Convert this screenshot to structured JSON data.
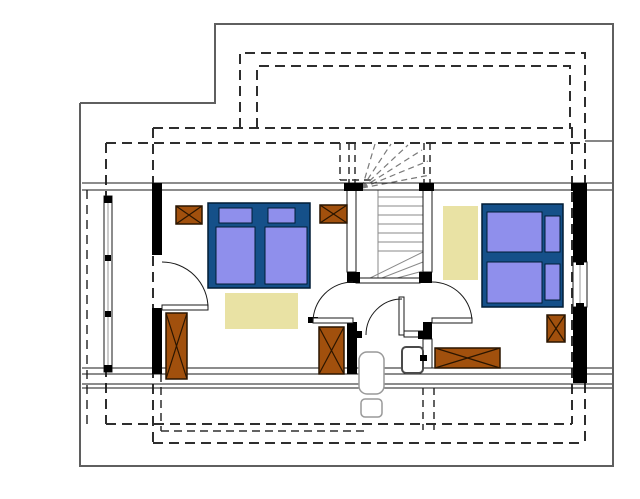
{
  "canvas": {
    "width": 640,
    "height": 499,
    "background": "#ffffff"
  },
  "colors": {
    "ink": "#1a1a1a",
    "wall": "#000000",
    "outline": "#5f5f5f",
    "dash": "#2e2e2e",
    "stairline": "#8a8a8a",
    "winderdash": "#7a7a7a",
    "brown": "#A1500D",
    "brownedge": "#2a1500",
    "bedframe": "#155089",
    "bededge": "#001c35",
    "mattress": "#8F8FEC",
    "rug": "#E9E2A4",
    "white": "#ffffff",
    "gray2": "#999999",
    "apedge": "#4a4a4a",
    "none": "none"
  },
  "shapes": [
    {
      "n": "ground-floor-outline",
      "t": "pl",
      "pts": "80,103 215,103 215,24 613,24 613,466 80,466 80,103",
      "s": "outline",
      "sw": 2
    },
    {
      "n": "ground-floor-edge-line",
      "t": "l",
      "x1": 585,
      "y1": 141,
      "x2": 613,
      "y2": 141,
      "s": "outline",
      "sw": 1.5
    },
    {
      "n": "dormer-roof-outer-dashed",
      "t": "p",
      "d": "M240,128 L240,53 L585,53 L585,141",
      "s": "dash",
      "sw": 2,
      "da": "10,6"
    },
    {
      "n": "dormer-roof-inner-dashed",
      "t": "p",
      "d": "M257,128 L257,66 L570,66 L570,128",
      "s": "dash",
      "sw": 2,
      "da": "10,6"
    },
    {
      "n": "roof-edge-top-inner",
      "t": "l",
      "x1": 153,
      "y1": 128,
      "x2": 573,
      "y2": 128,
      "s": "dash",
      "sw": 2,
      "da": "10,6"
    },
    {
      "n": "roof-edge-top-outer",
      "t": "l",
      "x1": 106,
      "y1": 143,
      "x2": 585,
      "y2": 143,
      "s": "dash",
      "sw": 2,
      "da": "10,6"
    },
    {
      "n": "roof-edge-left-outer",
      "t": "l",
      "x1": 106,
      "y1": 143,
      "x2": 106,
      "y2": 424,
      "s": "dash",
      "sw": 2,
      "da": "10,6"
    },
    {
      "n": "roof-edge-left-far",
      "t": "l",
      "x1": 87,
      "y1": 190,
      "x2": 87,
      "y2": 424,
      "s": "dash",
      "sw": 1.5,
      "da": "9,6"
    },
    {
      "n": "roof-edge-left-inner",
      "t": "l",
      "x1": 153,
      "y1": 128,
      "x2": 153,
      "y2": 443,
      "s": "dash",
      "sw": 2,
      "da": "10,6"
    },
    {
      "n": "roof-edge-left-short",
      "t": "l",
      "x1": 161,
      "y1": 374,
      "x2": 161,
      "y2": 431,
      "s": "dash",
      "sw": 1.5,
      "da": "8,5"
    },
    {
      "n": "roof-edge-right-inner",
      "t": "l",
      "x1": 572,
      "y1": 128,
      "x2": 572,
      "y2": 424,
      "s": "dash",
      "sw": 2,
      "da": "10,6"
    },
    {
      "n": "roof-edge-right-outer",
      "t": "l",
      "x1": 585,
      "y1": 143,
      "x2": 585,
      "y2": 441,
      "s": "dash",
      "sw": 2,
      "da": "10,6"
    },
    {
      "n": "roof-edge-bottom-inner",
      "t": "l",
      "x1": 106,
      "y1": 424,
      "x2": 572,
      "y2": 424,
      "s": "dash",
      "sw": 2,
      "da": "10,6"
    },
    {
      "n": "roof-edge-bottom-mid",
      "t": "l",
      "x1": 161,
      "y1": 431,
      "x2": 365,
      "y2": 431,
      "s": "dash",
      "sw": 1.5,
      "da": "8,5"
    },
    {
      "n": "roof-edge-bottom-outer",
      "t": "l",
      "x1": 153,
      "y1": 443,
      "x2": 585,
      "y2": 443,
      "s": "dash",
      "sw": 2,
      "da": "10,6"
    },
    {
      "n": "projection-dashed-1",
      "t": "l",
      "x1": 423,
      "y1": 388,
      "x2": 423,
      "y2": 430,
      "s": "dash",
      "sw": 1.5,
      "da": "7,5"
    },
    {
      "n": "projection-dashed-2",
      "t": "l",
      "x1": 434,
      "y1": 388,
      "x2": 434,
      "y2": 430,
      "s": "dash",
      "sw": 1.5,
      "da": "7,5"
    },
    {
      "n": "stairwell-dashed-wall-1",
      "t": "l",
      "x1": 349,
      "y1": 143,
      "x2": 349,
      "y2": 183,
      "s": "dash",
      "sw": 1.5,
      "da": "7,5"
    },
    {
      "n": "stairwell-dashed-wall-2",
      "t": "l",
      "x1": 355,
      "y1": 143,
      "x2": 355,
      "y2": 183,
      "s": "dash",
      "sw": 1.5,
      "da": "7,5"
    },
    {
      "n": "stairwell-dashed-wall-3",
      "t": "l",
      "x1": 424,
      "y1": 143,
      "x2": 424,
      "y2": 183,
      "s": "dash",
      "sw": 1.5,
      "da": "7,5"
    },
    {
      "n": "stairwell-dashed-wall-4",
      "t": "l",
      "x1": 430,
      "y1": 143,
      "x2": 430,
      "y2": 183,
      "s": "dash",
      "sw": 1.5,
      "da": "7,5"
    },
    {
      "n": "stair-landing-dashed-v",
      "t": "l",
      "x1": 340,
      "y1": 143,
      "x2": 340,
      "y2": 180,
      "s": "dash",
      "sw": 1.5,
      "da": "7,5"
    },
    {
      "n": "stair-landing-dashed-h",
      "t": "l",
      "x1": 340,
      "y1": 180,
      "x2": 374,
      "y2": 180,
      "s": "dash",
      "sw": 1.5,
      "da": "7,5"
    },
    {
      "n": "rug-bedroom-1",
      "t": "r",
      "x": 225,
      "y": 293,
      "wd": 73,
      "ht": 36,
      "f": "rug",
      "s": "none",
      "sw": 0
    },
    {
      "n": "rug-bedroom-2",
      "t": "r",
      "x": 443,
      "y": 206,
      "wd": 35,
      "ht": 74,
      "f": "rug",
      "s": "none",
      "sw": 0
    },
    {
      "n": "stair-winder-dashed-1",
      "t": "l",
      "x1": 362,
      "y1": 188,
      "x2": 375,
      "y2": 144,
      "s": "winderdash",
      "sw": 1.2,
      "da": "6,4"
    },
    {
      "n": "stair-winder-dashed-2",
      "t": "l",
      "x1": 362,
      "y1": 188,
      "x2": 391,
      "y2": 144,
      "s": "winderdash",
      "sw": 1.2,
      "da": "6,4"
    },
    {
      "n": "stair-winder-dashed-3",
      "t": "l",
      "x1": 362,
      "y1": 188,
      "x2": 408,
      "y2": 145,
      "s": "winderdash",
      "sw": 1.2,
      "da": "6,4"
    },
    {
      "n": "stair-winder-dashed-4",
      "t": "l",
      "x1": 362,
      "y1": 188,
      "x2": 422,
      "y2": 150,
      "s": "winderdash",
      "sw": 1.2,
      "da": "6,4"
    },
    {
      "n": "stair-winder-dashed-5",
      "t": "l",
      "x1": 362,
      "y1": 188,
      "x2": 428,
      "y2": 161,
      "s": "winderdash",
      "sw": 1.2,
      "da": "6,4"
    },
    {
      "n": "stair-winder-dashed-6",
      "t": "l",
      "x1": 362,
      "y1": 188,
      "x2": 430,
      "y2": 175,
      "s": "winderdash",
      "sw": 1.2,
      "da": "6,4"
    },
    {
      "n": "stair-tread-1",
      "t": "l",
      "x1": 378,
      "y1": 197,
      "x2": 423,
      "y2": 197,
      "s": "stairline",
      "sw": 1
    },
    {
      "n": "stair-tread-2",
      "t": "l",
      "x1": 378,
      "y1": 206,
      "x2": 423,
      "y2": 206,
      "s": "stairline",
      "sw": 1
    },
    {
      "n": "stair-tread-3",
      "t": "l",
      "x1": 378,
      "y1": 215,
      "x2": 423,
      "y2": 215,
      "s": "stairline",
      "sw": 1
    },
    {
      "n": "stair-tread-4",
      "t": "l",
      "x1": 378,
      "y1": 224,
      "x2": 423,
      "y2": 224,
      "s": "stairline",
      "sw": 1
    },
    {
      "n": "stair-tread-5",
      "t": "l",
      "x1": 378,
      "y1": 233,
      "x2": 423,
      "y2": 233,
      "s": "stairline",
      "sw": 1
    },
    {
      "n": "stair-tread-6",
      "t": "l",
      "x1": 378,
      "y1": 242,
      "x2": 423,
      "y2": 242,
      "s": "stairline",
      "sw": 1
    },
    {
      "n": "stair-tread-7",
      "t": "l",
      "x1": 378,
      "y1": 251,
      "x2": 423,
      "y2": 251,
      "s": "stairline",
      "sw": 1
    },
    {
      "n": "stair-string-line",
      "t": "l",
      "x1": 378,
      "y1": 190,
      "x2": 378,
      "y2": 283,
      "s": "stairline",
      "sw": 1
    },
    {
      "n": "stair-winder-solid-1",
      "t": "l",
      "x1": 360,
      "y1": 283,
      "x2": 423,
      "y2": 252,
      "s": "stairline",
      "sw": 1
    },
    {
      "n": "stair-winder-solid-2",
      "t": "l",
      "x1": 369,
      "y1": 283,
      "x2": 423,
      "y2": 262,
      "s": "stairline",
      "sw": 1
    },
    {
      "n": "stair-winder-solid-3",
      "t": "l",
      "x1": 379,
      "y1": 283,
      "x2": 423,
      "y2": 271,
      "s": "stairline",
      "sw": 1
    },
    {
      "n": "stair-winder-solid-4",
      "t": "l",
      "x1": 391,
      "y1": 283,
      "x2": 423,
      "y2": 278,
      "s": "stairline",
      "sw": 1
    },
    {
      "n": "north-wall-line-1",
      "t": "l",
      "x1": 82,
      "y1": 183,
      "x2": 612,
      "y2": 183,
      "s": "ink",
      "sw": 1
    },
    {
      "n": "north-wall-line-2",
      "t": "l",
      "x1": 82,
      "y1": 190,
      "x2": 612,
      "y2": 190,
      "s": "ink",
      "sw": 1
    },
    {
      "n": "south-wall-line-1",
      "t": "l",
      "x1": 82,
      "y1": 368,
      "x2": 612,
      "y2": 368,
      "s": "ink",
      "sw": 1
    },
    {
      "n": "south-wall-line-2",
      "t": "l",
      "x1": 82,
      "y1": 374,
      "x2": 612,
      "y2": 374,
      "s": "ink",
      "sw": 1
    },
    {
      "n": "south-wall-line-3",
      "t": "l",
      "x1": 82,
      "y1": 384,
      "x2": 612,
      "y2": 384,
      "s": "ink",
      "sw": 1
    },
    {
      "n": "south-wall-line-4",
      "t": "l",
      "x1": 82,
      "y1": 388,
      "x2": 612,
      "y2": 388,
      "s": "ink",
      "sw": 1
    },
    {
      "n": "stair-wall-left",
      "t": "r",
      "x": 347,
      "y": 190,
      "wd": 9,
      "ht": 82,
      "f": "white",
      "s": "ink",
      "sw": 1
    },
    {
      "n": "stair-wall-right",
      "t": "r",
      "x": 423,
      "y": 190,
      "wd": 9,
      "ht": 82,
      "f": "white",
      "s": "ink",
      "sw": 1
    },
    {
      "n": "stair-wall-right-lower",
      "t": "r",
      "x": 423,
      "y": 339,
      "wd": 9,
      "ht": 29,
      "f": "white",
      "s": "ink",
      "sw": 1
    },
    {
      "n": "bath-partition-wall",
      "t": "r",
      "x": 404,
      "y": 331,
      "wd": 21,
      "ht": 6,
      "f": "white",
      "s": "ink",
      "sw": 1
    },
    {
      "n": "stair-base-edge",
      "t": "r",
      "x": 356,
      "y": 278,
      "wd": 64,
      "ht": 5,
      "f": "white",
      "s": "ink",
      "sw": 1
    },
    {
      "n": "west-window",
      "t": "r",
      "x": 104,
      "y": 196,
      "wd": 8,
      "ht": 176,
      "f": "white",
      "s": "ink",
      "sw": 1
    },
    {
      "n": "west-window-glass-line",
      "t": "l",
      "x1": 108,
      "y1": 202,
      "x2": 108,
      "y2": 366,
      "s": "gray2",
      "sw": 1
    },
    {
      "n": "east-window",
      "t": "r",
      "x": 573,
      "y": 262,
      "wd": 14,
      "ht": 45,
      "f": "white",
      "s": "ink",
      "sw": 1
    },
    {
      "n": "east-window-glass-line",
      "t": "l",
      "x1": 580,
      "y1": 262,
      "x2": 580,
      "y2": 307,
      "s": "gray2",
      "sw": 1
    },
    {
      "n": "wall-north-stair-left",
      "t": "r",
      "x": 344,
      "y": 183,
      "wd": 19,
      "ht": 8,
      "f": "wall",
      "s": "none",
      "sw": 0
    },
    {
      "n": "wall-north-stair-right",
      "t": "r",
      "x": 419,
      "y": 183,
      "wd": 15,
      "ht": 8,
      "f": "wall",
      "s": "none",
      "sw": 0
    },
    {
      "n": "wall-north-east",
      "t": "r",
      "x": 571,
      "y": 183,
      "wd": 16,
      "ht": 8,
      "f": "wall",
      "s": "none",
      "sw": 0
    },
    {
      "n": "wall-west-upper",
      "t": "r",
      "x": 152,
      "y": 183,
      "wd": 10,
      "ht": 72,
      "f": "wall",
      "s": "none",
      "sw": 0
    },
    {
      "n": "wall-west-lower",
      "t": "r",
      "x": 152,
      "y": 308,
      "wd": 10,
      "ht": 66,
      "f": "wall",
      "s": "none",
      "sw": 0
    },
    {
      "n": "wall-hall-stub-left",
      "t": "r",
      "x": 347,
      "y": 272,
      "wd": 13,
      "ht": 11,
      "f": "wall",
      "s": "none",
      "sw": 0
    },
    {
      "n": "wall-hall-stub-right",
      "t": "r",
      "x": 419,
      "y": 272,
      "wd": 13,
      "ht": 11,
      "f": "wall",
      "s": "none",
      "sw": 0
    },
    {
      "n": "wall-hall-left-lower",
      "t": "r",
      "x": 347,
      "y": 322,
      "wd": 10,
      "ht": 52,
      "f": "wall",
      "s": "none",
      "sw": 0
    },
    {
      "n": "wall-hall-right-stub-lower",
      "t": "r",
      "x": 423,
      "y": 322,
      "wd": 9,
      "ht": 17,
      "f": "wall",
      "s": "none",
      "sw": 0
    },
    {
      "n": "wall-bath-stub-west",
      "t": "r",
      "x": 347,
      "y": 331,
      "wd": 15,
      "ht": 7,
      "f": "wall",
      "s": "none",
      "sw": 0
    },
    {
      "n": "wall-bath-stub-east",
      "t": "r",
      "x": 418,
      "y": 331,
      "wd": 7,
      "ht": 8,
      "f": "wall",
      "s": "none",
      "sw": 0
    },
    {
      "n": "door-stop-stub",
      "t": "r",
      "x": 308,
      "y": 317,
      "wd": 10,
      "ht": 6,
      "f": "wall",
      "s": "none",
      "sw": 0
    },
    {
      "n": "wall-east-upper",
      "t": "r",
      "x": 573,
      "y": 188,
      "wd": 14,
      "ht": 74,
      "f": "wall",
      "s": "none",
      "sw": 0
    },
    {
      "n": "wall-east-lower",
      "t": "r",
      "x": 573,
      "y": 307,
      "wd": 14,
      "ht": 76,
      "f": "wall",
      "s": "none",
      "sw": 0
    },
    {
      "n": "west-window-cap-top",
      "t": "r",
      "x": 104,
      "y": 196,
      "wd": 8,
      "ht": 7,
      "f": "wall",
      "s": "none",
      "sw": 0
    },
    {
      "n": "west-window-cap-bottom",
      "t": "r",
      "x": 104,
      "y": 365,
      "wd": 8,
      "ht": 7,
      "f": "wall",
      "s": "none",
      "sw": 0
    },
    {
      "n": "west-window-mullion-1",
      "t": "r",
      "x": 105,
      "y": 255,
      "wd": 6,
      "ht": 6,
      "f": "wall",
      "s": "none",
      "sw": 0
    },
    {
      "n": "west-window-mullion-2",
      "t": "r",
      "x": 105,
      "y": 311,
      "wd": 6,
      "ht": 6,
      "f": "wall",
      "s": "none",
      "sw": 0
    },
    {
      "n": "east-window-cap-top",
      "t": "r",
      "x": 576,
      "y": 260,
      "wd": 8,
      "ht": 5,
      "f": "wall",
      "s": "none",
      "sw": 0
    },
    {
      "n": "east-window-cap-bottom",
      "t": "r",
      "x": 576,
      "y": 303,
      "wd": 8,
      "ht": 5,
      "f": "wall",
      "s": "none",
      "sw": 0
    },
    {
      "n": "door-bedroom1-leaf",
      "t": "r",
      "x": 313,
      "y": 318,
      "wd": 40,
      "ht": 5,
      "f": "white",
      "s": "ink",
      "sw": 1
    },
    {
      "n": "door-bedroom1-swing",
      "t": "p",
      "d": "M313,322 A40,40 0 0 1 353,282",
      "s": "ink",
      "sw": 1
    },
    {
      "n": "door-bedroom2-leaf",
      "t": "r",
      "x": 432,
      "y": 318,
      "wd": 40,
      "ht": 5,
      "f": "white",
      "s": "ink",
      "sw": 1
    },
    {
      "n": "door-bedroom2-swing",
      "t": "p",
      "d": "M432,282 A40,40 0 0 1 472,322",
      "s": "ink",
      "sw": 1
    },
    {
      "n": "door-bath-leaf",
      "t": "r",
      "x": 399,
      "y": 297,
      "wd": 5,
      "ht": 38,
      "f": "white",
      "s": "ink",
      "sw": 1
    },
    {
      "n": "door-bath-swing",
      "t": "p",
      "d": "M366,335 A36,36 0 0 1 402,299",
      "s": "ink",
      "sw": 1
    },
    {
      "n": "door-balcony-leaf",
      "t": "r",
      "x": 162,
      "y": 305,
      "wd": 46,
      "ht": 5,
      "f": "white",
      "s": "ink",
      "sw": 1
    },
    {
      "n": "door-balcony-swing",
      "t": "p",
      "d": "M208,308 A46,46 0 0 0 162,262",
      "s": "ink",
      "sw": 1
    },
    {
      "n": "bed-1-frame",
      "t": "r",
      "x": 208,
      "y": 203,
      "wd": 102,
      "ht": 85,
      "f": "bedframe",
      "s": "bededge",
      "sw": 1.5
    },
    {
      "n": "bed-1-mattress-left",
      "t": "r",
      "x": 216,
      "y": 227,
      "wd": 39,
      "ht": 57,
      "f": "mattress",
      "s": "bededge",
      "sw": 1
    },
    {
      "n": "bed-1-mattress-right",
      "t": "r",
      "x": 265,
      "y": 227,
      "wd": 42,
      "ht": 57,
      "f": "mattress",
      "s": "bededge",
      "sw": 1
    },
    {
      "n": "bed-1-pillow-left",
      "t": "r",
      "x": 219,
      "y": 208,
      "wd": 33,
      "ht": 15,
      "f": "mattress",
      "s": "bededge",
      "sw": 1
    },
    {
      "n": "bed-1-pillow-right",
      "t": "r",
      "x": 268,
      "y": 208,
      "wd": 27,
      "ht": 15,
      "f": "mattress",
      "s": "bededge",
      "sw": 1
    },
    {
      "n": "bed-2-frame",
      "t": "r",
      "x": 482,
      "y": 204,
      "wd": 81,
      "ht": 103,
      "f": "bedframe",
      "s": "bededge",
      "sw": 1.5
    },
    {
      "n": "bed-2-mattress-top",
      "t": "r",
      "x": 487,
      "y": 212,
      "wd": 55,
      "ht": 40,
      "f": "mattress",
      "s": "bededge",
      "sw": 1
    },
    {
      "n": "bed-2-mattress-bottom",
      "t": "r",
      "x": 487,
      "y": 262,
      "wd": 55,
      "ht": 41,
      "f": "mattress",
      "s": "bededge",
      "sw": 1
    },
    {
      "n": "bed-2-pillow-top",
      "t": "r",
      "x": 545,
      "y": 216,
      "wd": 15,
      "ht": 36,
      "f": "mattress",
      "s": "bededge",
      "sw": 1
    },
    {
      "n": "bed-2-pillow-bottom",
      "t": "r",
      "x": 545,
      "y": 264,
      "wd": 15,
      "ht": 36,
      "f": "mattress",
      "s": "bededge",
      "sw": 1
    },
    {
      "n": "nightstand-bedroom1-left",
      "t": "xb",
      "x": 176,
      "y": 206,
      "wd": 26,
      "ht": 18
    },
    {
      "n": "nightstand-bedroom1-right",
      "t": "xb",
      "x": 320,
      "y": 205,
      "wd": 27,
      "ht": 18
    },
    {
      "n": "wardrobe-bedroom1",
      "t": "xb",
      "x": 166,
      "y": 313,
      "wd": 21,
      "ht": 66
    },
    {
      "n": "cabinet-bedroom1",
      "t": "xb",
      "x": 319,
      "y": 327,
      "wd": 25,
      "ht": 47
    },
    {
      "n": "nightstand-bedroom2",
      "t": "xb",
      "x": 547,
      "y": 315,
      "wd": 18,
      "ht": 27
    },
    {
      "n": "dresser-bedroom2",
      "t": "xb",
      "x": 435,
      "y": 348,
      "wd": 65,
      "ht": 20
    },
    {
      "n": "appliance-box",
      "t": "r",
      "x": 402,
      "y": 347,
      "wd": 21,
      "ht": 26,
      "rx": 4,
      "f": "white",
      "s": "apedge",
      "sw": 2
    },
    {
      "n": "appliance-handle",
      "t": "r",
      "x": 420,
      "y": 355,
      "wd": 7,
      "ht": 6,
      "f": "wall",
      "s": "none",
      "sw": 0
    },
    {
      "n": "chair-outline-back",
      "t": "r",
      "x": 359,
      "y": 352,
      "wd": 25,
      "ht": 42,
      "rx": 8,
      "f": "white",
      "s": "gray2",
      "sw": 1.5
    },
    {
      "n": "chair-outline-seat",
      "t": "r",
      "x": 361,
      "y": 399,
      "wd": 21,
      "ht": 18,
      "rx": 4,
      "f": "white",
      "s": "gray2",
      "sw": 1.5
    }
  ]
}
